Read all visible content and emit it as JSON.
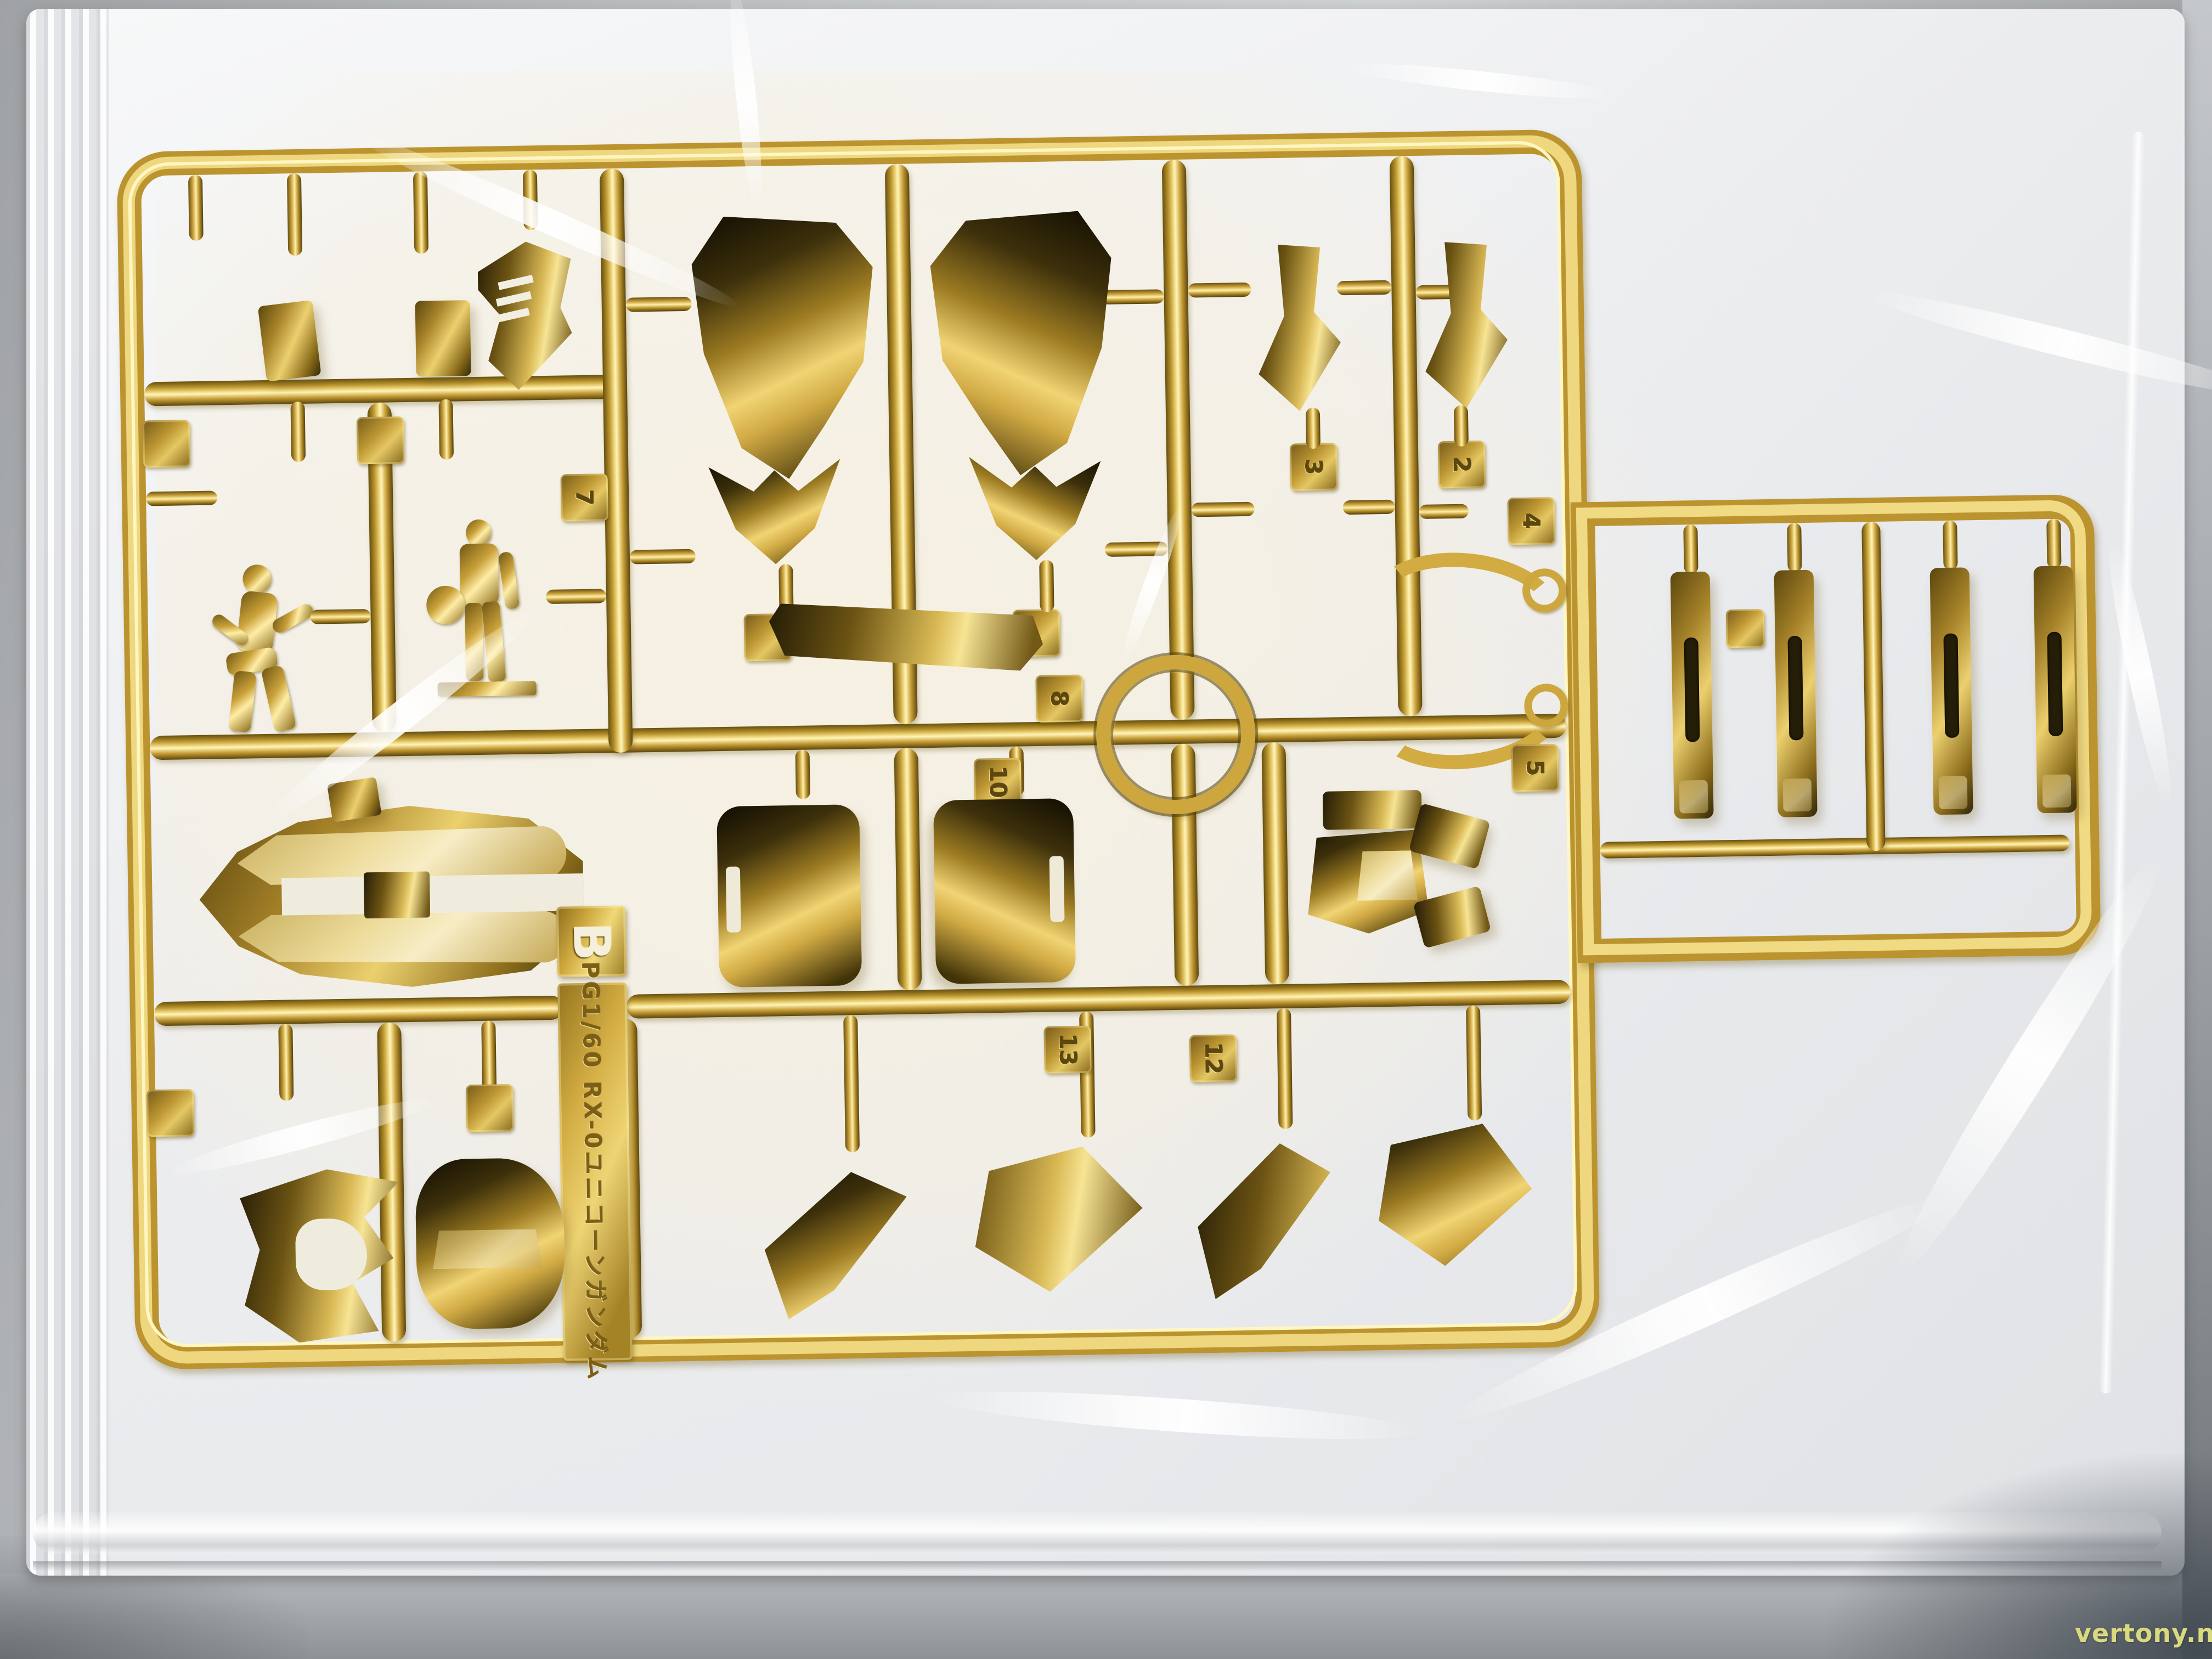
{
  "photo": {
    "subject": "Gold chrome-plated model kit runner (sprue) sealed in a clear plastic bag on a gray table"
  },
  "runner_label": {
    "letter": "B",
    "kit_name": "PG1/60 RX-0ユニコーンガンダム"
  },
  "part_tags": {
    "t2": "2",
    "t3": "3",
    "t4": "4",
    "t5": "5",
    "t7": "7",
    "t8": "8",
    "t10": "10",
    "t12": "12",
    "t13": "13"
  },
  "watermark": {
    "text": "vertony.net",
    "color": "#d9da7f"
  },
  "colors": {
    "gold_highlight": "#fff3b8",
    "gold_mid": "#c9a23a",
    "gold_deep": "#6a520f",
    "gold_dark_reflection": "#241c06",
    "bag_white": "#eff0f2",
    "backing_cream": "#f2eee1",
    "surface_gray": "#b4b7ba",
    "surface_dark": "#666c71"
  }
}
